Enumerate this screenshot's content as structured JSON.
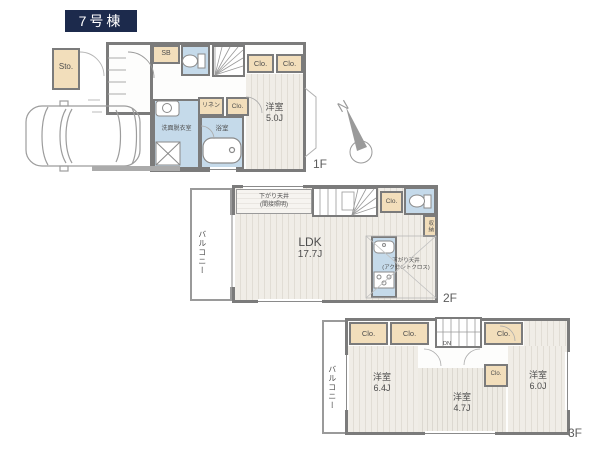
{
  "title": "7号棟",
  "compass": {
    "north": "N"
  },
  "colors": {
    "title_bg": "#1c2a4c",
    "wall": "#7b7b7b",
    "closet_fill": "#f2debb",
    "wet_area_fill": "#c5daea",
    "floor_stripe": "#e1ddd5"
  },
  "floors": {
    "f1": {
      "label": "1F",
      "sto": "Sto.",
      "sb": "SB",
      "clo_a": "Clo.",
      "clo_b": "Clo.",
      "linen": "リネン",
      "clo_c": "Clo.",
      "washroom": "洗面脱衣室",
      "bath": "浴室",
      "room_name": "洋室",
      "room_size": "5.0J"
    },
    "f2": {
      "label": "2F",
      "balcony": "バルコニー",
      "ceiling_note_1": "下がり天井",
      "ceiling_note_2": "(間接照明)",
      "clo": "Clo.",
      "storage": "収納",
      "ldk_name": "LDK",
      "ldk_size": "17.7J",
      "kitchen_note_1": "下がり天井",
      "kitchen_note_2": "(アクセントクロス)"
    },
    "f3": {
      "label": "3F",
      "balcony": "バルコニー",
      "closets": [
        "Clo.",
        "Clo.",
        "Clo.",
        "Clo."
      ],
      "dn": "DN",
      "rooms": [
        {
          "name": "洋室",
          "size": "6.4J"
        },
        {
          "name": "洋室",
          "size": "4.7J"
        },
        {
          "name": "洋室",
          "size": "6.0J"
        }
      ]
    }
  }
}
